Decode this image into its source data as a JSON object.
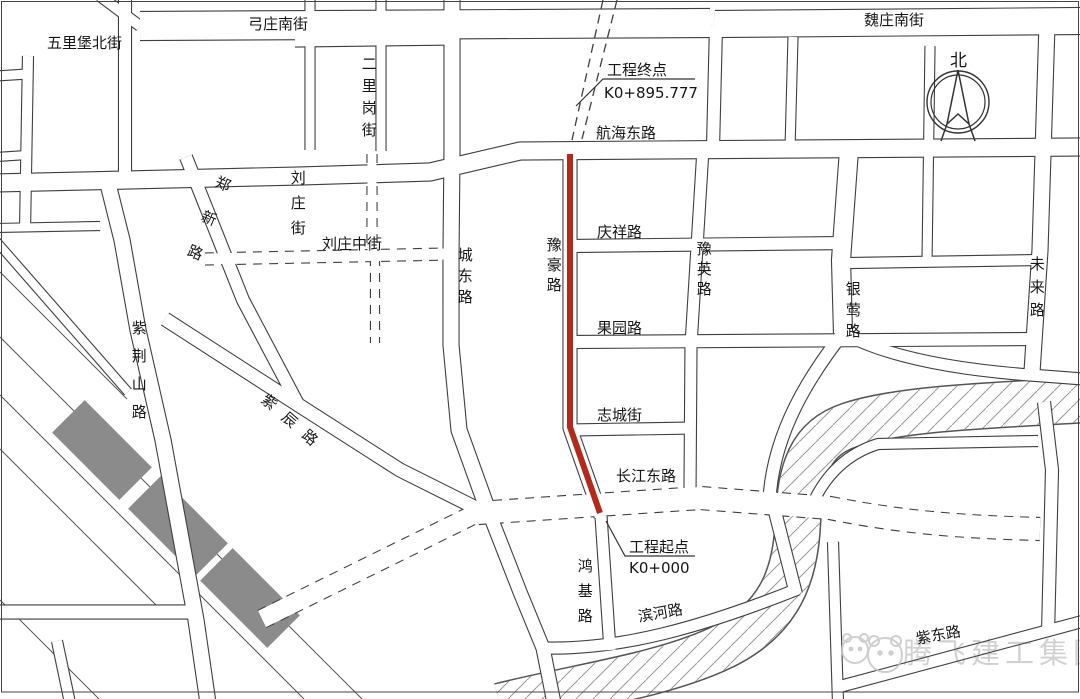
{
  "map_type": "construction-location-plan",
  "streets": [
    {
      "name": "五里堡北街"
    },
    {
      "name": "弓庄南街"
    },
    {
      "name": "魏庄南街"
    },
    {
      "name": "二里岗街"
    },
    {
      "name": "航海东路"
    },
    {
      "name": "郑新路"
    },
    {
      "name": "刘庄街"
    },
    {
      "name": "刘庄中街"
    },
    {
      "name": "城东路"
    },
    {
      "name": "豫豪路"
    },
    {
      "name": "庆祥路"
    },
    {
      "name": "豫英路"
    },
    {
      "name": "银莺路"
    },
    {
      "name": "未来路"
    },
    {
      "name": "果园路"
    },
    {
      "name": "志城街"
    },
    {
      "name": "紫荆山路"
    },
    {
      "name": "紫辰路"
    },
    {
      "name": "长江东路"
    },
    {
      "name": "鸿基路"
    },
    {
      "name": "滨河路"
    },
    {
      "name": "紫东路"
    }
  ],
  "annotations": {
    "end_label": "工程终点",
    "end_chainage": "K0+895.777",
    "start_label": "工程起点",
    "start_chainage": "K0+000"
  },
  "compass": {
    "label": "北"
  },
  "watermark": {
    "text": "腾飞建工集团"
  },
  "highlight": {
    "road": "豫豪路",
    "meaning": "project-alignment"
  },
  "colors": {
    "road_line": "#3f3f3f",
    "project_red": "#b5291c",
    "railway_block": "#8b8b8b",
    "hatch": "#999999",
    "watermark": "#bdbdbd"
  }
}
